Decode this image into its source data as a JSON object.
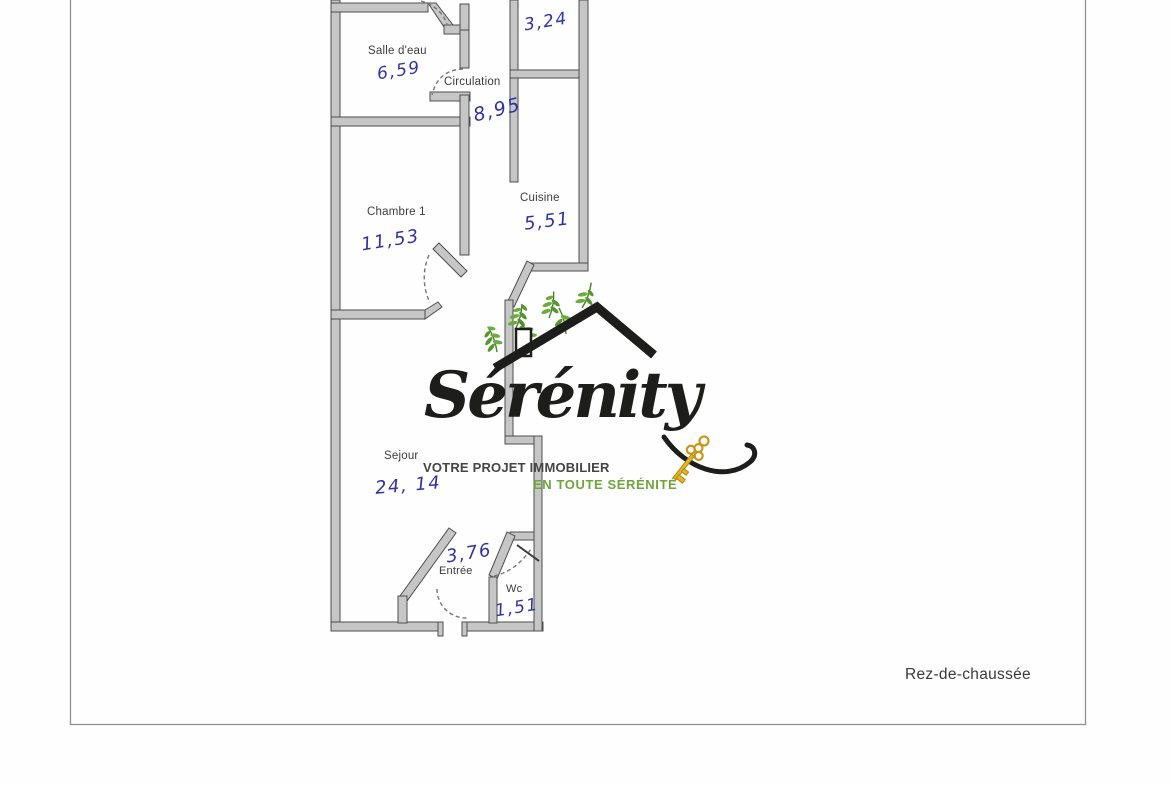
{
  "page": {
    "floor_label": "Rez-de-chaussée",
    "background": "#fefefe",
    "border_color": "#8f8f8f"
  },
  "logo": {
    "brand": "Sérénity",
    "tagline_line1": "VOTRE PROJET IMMOBILIER",
    "tagline_line2": "EN TOUTE SÉRÉNITÉ",
    "colors": {
      "brand": "#1d1d1b",
      "roof": "#1d1d1b",
      "tagline1": "#454545",
      "tagline2": "#6fa53b",
      "key": "#e2b622",
      "foliage": "#579631"
    }
  },
  "floor_plan": {
    "ink_color": "#3232a2",
    "wall_fill": "#c6c6c6",
    "wall_edge": "#4e4e4e",
    "label_color": "#3c3c3c",
    "rooms": [
      {
        "id": "piece-haut",
        "label": "",
        "area_m2": "3,24"
      },
      {
        "id": "salle-deau",
        "label": "Salle d'eau",
        "area_m2": "6,59"
      },
      {
        "id": "circulation",
        "label": "Circulation",
        "area_m2": "8,95"
      },
      {
        "id": "chambre-1",
        "label": "Chambre 1",
        "area_m2": "11,53"
      },
      {
        "id": "cuisine",
        "label": "Cuisine",
        "area_m2": "5,51"
      },
      {
        "id": "sejour",
        "label": "Sejour",
        "area_m2": "24, 14"
      },
      {
        "id": "entree",
        "label": "Entrée",
        "area_m2": "3,76"
      },
      {
        "id": "wc",
        "label": "Wc",
        "area_m2": "1,51"
      }
    ]
  }
}
